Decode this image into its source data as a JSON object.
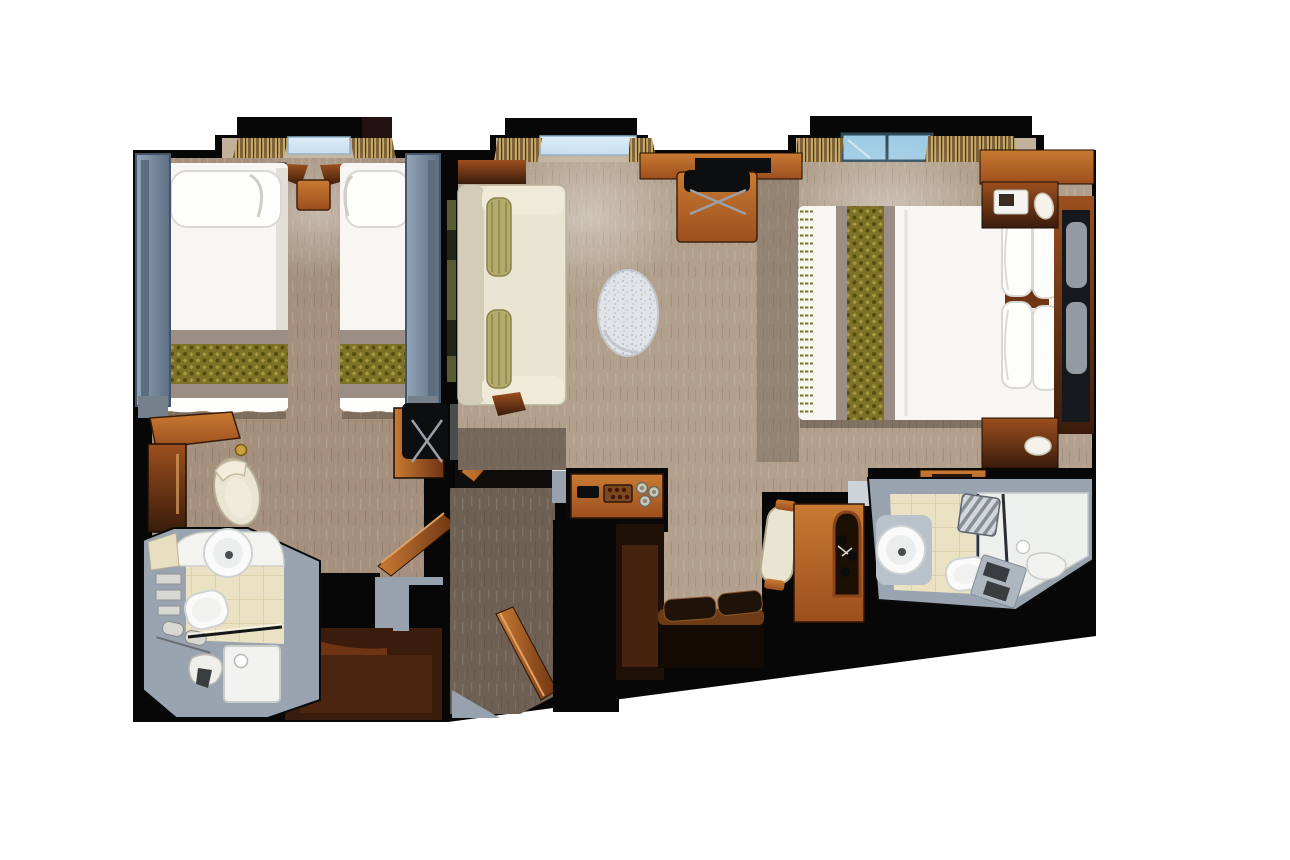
{
  "scene": {
    "kind": "floor-plan-render",
    "view": "top-down-3d",
    "rooms": [
      "twin-bed-stateroom",
      "entry-vestibule",
      "living-area-suite",
      "master-bedroom",
      "bathroom-left",
      "bathroom-right"
    ]
  },
  "objects": {
    "twin-bed-1": "white bed with olive damask runner",
    "twin-bed-2": "white bed with olive damask runner",
    "master-bed": "white bed, olive runner, four pillows",
    "sofa": "cream sofa with two olive bolsters",
    "oval-rug": "speckled oval rug/table",
    "desk": "wood desk with black chair",
    "minibar-console": "wood console with glasses and tray",
    "vanity": "wood vanity with arch mirror and cream chair",
    "toilet": "white toilet",
    "sink": "round white basin",
    "shower": "white shower tray with glass screen",
    "wardrobe": "wood wardrobe cabinet",
    "windows": "three bay windows with gold curtains"
  },
  "palette": {
    "bg": "#ffffff",
    "wall": "#070707",
    "liner": "#98a2ae",
    "liner_light": "#cdd3da",
    "carpet_left": "#a4907d",
    "carpet_main": "#b2a08d",
    "carpet_alcove": "#c1b19b",
    "carpet_corridor": "#6e6053",
    "wood_light": "#c97a33",
    "wood_mid": "#9c4f1d",
    "wood_dark": "#6e3413",
    "wood_deep": "#3a1c0c",
    "wood_blackish": "#1f1108",
    "bedding": "#f7f6f3",
    "pillow": "#fdfdfb",
    "pillow_line": "#d9d8d2",
    "runner_olive": "#7e7228",
    "runner_olive_dk": "#554c10",
    "runner_olive_lt": "#a89a42",
    "mauve": "#9c8d86",
    "blue_lt": "#93a5b8",
    "blue_dk": "#5d6e82",
    "blue_border": "#46566a",
    "sofa_cream": "#eae4d2",
    "sofa_dk": "#d3ccb6",
    "bolster": "#b3ab6c",
    "bolster_dk": "#8a814a",
    "curtain_gold": "#c4a96a",
    "curtain_dk": "#7e6336",
    "curtain_line": "#4a3416",
    "glass_blue": "#c3ddee",
    "glass_blue2": "#9ecbe4",
    "frame_teal": "#2c4a58",
    "rug": "#e0e4e8",
    "rug_dot": "#a9b2bb",
    "bath_gray": "#9aa4b1",
    "bath_gray_dk": "#7d8795",
    "tile": "#ebe2c3",
    "tile_line": "#d5c8a0",
    "white_fix": "#fafafa",
    "fix_line": "#cfd3d2",
    "mirror": "#15181c",
    "ghost": "#aab2ba",
    "metal": "#9aa0a6",
    "dark_obj": "#0d0e10",
    "gold": "#c9a23a",
    "towel": "#d8d8d2",
    "shadow": "#3a2d22"
  }
}
